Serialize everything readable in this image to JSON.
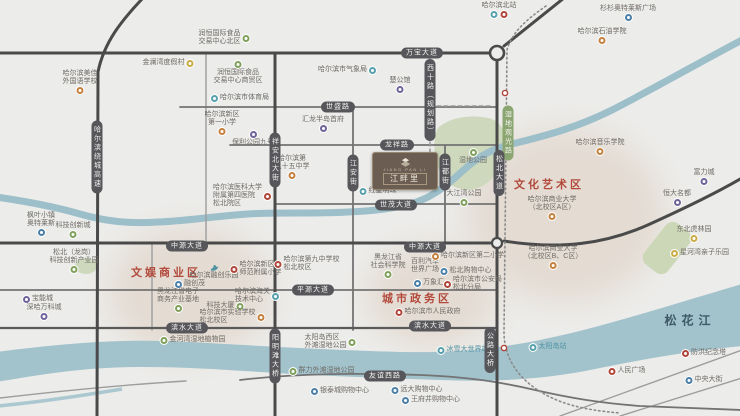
{
  "project": {
    "name": "江畔里",
    "tagline": "JIANG PAN LI"
  },
  "songhua_river": "松花江",
  "district_labels": [
    {
      "text": "文化艺术区",
      "x": 549,
      "y": 184
    },
    {
      "text": "文娱商业区",
      "x": 166,
      "y": 272
    },
    {
      "text": "城市政务区",
      "x": 417,
      "y": 298
    }
  ],
  "road_labels": [
    {
      "text": "万宝大道",
      "x": 422,
      "y": 53,
      "v": false,
      "green": false
    },
    {
      "text": "世盛路",
      "x": 338,
      "y": 107,
      "v": false,
      "green": false
    },
    {
      "text": "龙祥路",
      "x": 397,
      "y": 145,
      "v": false,
      "green": false
    },
    {
      "text": "世茂大道",
      "x": 396,
      "y": 205,
      "v": false,
      "green": false
    },
    {
      "text": "中源大道",
      "x": 187,
      "y": 246,
      "v": false,
      "green": false
    },
    {
      "text": "中源大道",
      "x": 425,
      "y": 247,
      "v": false,
      "green": false
    },
    {
      "text": "平源大道",
      "x": 313,
      "y": 290,
      "v": false,
      "green": false
    },
    {
      "text": "滨水大道",
      "x": 187,
      "y": 328,
      "v": false,
      "green": false
    },
    {
      "text": "滨水大道",
      "x": 430,
      "y": 326,
      "v": false,
      "green": false
    },
    {
      "text": "友谊西路",
      "x": 385,
      "y": 376,
      "v": false,
      "green": false
    },
    {
      "text": "哈尔滨绕城高速",
      "x": 97,
      "y": 157,
      "v": true,
      "green": false
    },
    {
      "text": "祥安北大街",
      "x": 275,
      "y": 160,
      "v": true,
      "green": false
    },
    {
      "text": "江安街",
      "x": 353,
      "y": 173,
      "v": true,
      "green": false
    },
    {
      "text": "江都街",
      "x": 445,
      "y": 172,
      "v": true,
      "green": false
    },
    {
      "text": "西十路（规划路）",
      "x": 430,
      "y": 100,
      "v": true,
      "green": false
    },
    {
      "text": "湿地观光路",
      "x": 508,
      "y": 133,
      "v": true,
      "green": true
    },
    {
      "text": "松北大道",
      "x": 499,
      "y": 173,
      "v": true,
      "green": false
    },
    {
      "text": "阳明滩大桥",
      "x": 275,
      "y": 356,
      "v": true,
      "green": false
    },
    {
      "text": "公路大桥",
      "x": 490,
      "y": 350,
      "v": true,
      "green": false
    }
  ],
  "pois": [
    {
      "lines": [
        "金澜湾度假村"
      ],
      "x": 168,
      "y": 63,
      "icon": "yellow",
      "pos": "right"
    },
    {
      "lines": [
        "哈尔滨美佳",
        "外国语学校"
      ],
      "x": 80,
      "y": 82,
      "icon": "orange",
      "pos": "below"
    },
    {
      "lines": [
        "润恒国际食品",
        "交易中心北区"
      ],
      "x": 224,
      "y": 38,
      "icon": "green",
      "pos": "right"
    },
    {
      "lines": [
        "润恒国际食品",
        "交易中心商贸区"
      ],
      "x": 238,
      "y": 73,
      "icon": "green",
      "pos": "above"
    },
    {
      "lines": [
        "哈尔滨市体育局"
      ],
      "x": 240,
      "y": 98,
      "icon": "teal",
      "pos": "left"
    },
    {
      "lines": [
        "哈尔滨市气象局"
      ],
      "x": 347,
      "y": 70,
      "icon": "teal",
      "pos": "right"
    },
    {
      "lines": [
        "楚公馆"
      ],
      "x": 400,
      "y": 85,
      "icon": "purple",
      "pos": "below"
    },
    {
      "lines": [
        "哈尔滨北站"
      ],
      "x": 499,
      "y": 10,
      "icon": [
        "teal",
        "red"
      ],
      "pos": "below"
    },
    {
      "lines": [
        "杉杉奥特莱斯广场"
      ],
      "x": 628,
      "y": 13,
      "icon": "blue",
      "pos": "below"
    },
    {
      "lines": [
        "哈尔滨石油学院"
      ],
      "x": 602,
      "y": 36,
      "icon": "orange",
      "pos": "below"
    },
    {
      "lines": [
        "哈尔滨新区",
        "第一小学"
      ],
      "x": 222,
      "y": 123,
      "icon": "orange",
      "pos": "below"
    },
    {
      "lines": [
        "保利公园九号"
      ],
      "x": 253,
      "y": 139,
      "icon": "purple",
      "pos": "above"
    },
    {
      "lines": [
        "汇龙半岛首府"
      ],
      "x": 323,
      "y": 124,
      "icon": "purple",
      "pos": "below"
    },
    {
      "lines": [
        "哈尔滨第",
        "九十五中学"
      ],
      "x": 292,
      "y": 167,
      "icon": "orange",
      "pos": "below"
    },
    {
      "lines": [
        "哈尔滨医科大学",
        "附属第四医院",
        "松北院区"
      ],
      "x": 242,
      "y": 196,
      "icon": "red",
      "pos": "right"
    },
    {
      "lines": [
        "红星明珠"
      ],
      "x": 378,
      "y": 191,
      "icon": "teal",
      "pos": "left"
    },
    {
      "lines": [
        "湿地公园"
      ],
      "x": 473,
      "y": 157,
      "icon": "green",
      "pos": "above"
    },
    {
      "lines": [
        "哈尔滨音乐学院"
      ],
      "x": 600,
      "y": 147,
      "icon": "orange",
      "pos": "below"
    },
    {
      "lines": [
        "哈尔滨商业大学",
        "（北校区A区）"
      ],
      "x": 552,
      "y": 208,
      "icon": "orange",
      "pos": "below"
    },
    {
      "lines": [
        "哈尔滨商业大学",
        "（北校区B、C区）"
      ],
      "x": 553,
      "y": 257,
      "icon": "orange",
      "pos": "below"
    },
    {
      "lines": [
        "富力城"
      ],
      "x": 704,
      "y": 177,
      "icon": "purple",
      "pos": "below"
    },
    {
      "lines": [
        "恒大名都"
      ],
      "x": 677,
      "y": 198,
      "icon": "purple",
      "pos": "below"
    },
    {
      "lines": [
        "东北虎林园"
      ],
      "x": 694,
      "y": 234,
      "icon": "yellow",
      "pos": "below"
    },
    {
      "lines": [
        "星河湾亲子乐园"
      ],
      "x": 700,
      "y": 253,
      "icon": "yellow",
      "pos": "left"
    },
    {
      "lines": [
        "大江湾公园"
      ],
      "x": 464,
      "y": 198,
      "icon": "green",
      "pos": "below"
    },
    {
      "lines": [
        "哈尔滨融创乐园"
      ],
      "x": 214,
      "y": 272,
      "icon": "swan",
      "pos": "above"
    },
    {
      "lines": [
        "融创茂"
      ],
      "x": 190,
      "y": 284,
      "icon": "blue",
      "pos": "left"
    },
    {
      "lines": [
        "哈尔滨新区",
        "师范附属小学"
      ],
      "x": 256,
      "y": 269,
      "icon": "red",
      "pos": "left"
    },
    {
      "lines": [
        "哈尔滨第九中学校",
        "松北校区"
      ],
      "x": 307,
      "y": 264,
      "icon": "red",
      "pos": "left"
    },
    {
      "lines": [
        "黑龙江省电子",
        "商务产业基地"
      ],
      "x": 178,
      "y": 300,
      "icon": "green",
      "pos": "below"
    },
    {
      "lines": [
        "科技大厦"
      ],
      "x": 225,
      "y": 306,
      "icon": "green",
      "pos": "right"
    },
    {
      "lines": [
        "哈尔滨海关",
        "技术中心"
      ],
      "x": 257,
      "y": 296,
      "icon": "teal",
      "pos": "right"
    },
    {
      "lines": [
        "哈尔滨市实验学校",
        "松北校区"
      ],
      "x": 232,
      "y": 317,
      "icon": "orange",
      "pos": "right"
    },
    {
      "lines": [
        "黑龙江省",
        "社会科学院"
      ],
      "x": 388,
      "y": 266,
      "icon": "green",
      "pos": "below"
    },
    {
      "lines": [
        "百利汽车",
        "世界广场"
      ],
      "x": 425,
      "y": 266,
      "icon": "none",
      "pos": "none"
    },
    {
      "lines": [
        "万象汇"
      ],
      "x": 429,
      "y": 283,
      "icon": "blue",
      "pos": "left"
    },
    {
      "lines": [
        "哈尔滨新区第二小学"
      ],
      "x": 468,
      "y": 256,
      "icon": "orange",
      "pos": "left"
    },
    {
      "lines": [
        "松北购物中心"
      ],
      "x": 466,
      "y": 271,
      "icon": "blue",
      "pos": "left"
    },
    {
      "lines": [
        "哈尔滨市公安局",
        "松北分局"
      ],
      "x": 473,
      "y": 284,
      "icon": "red",
      "pos": "left"
    },
    {
      "lines": [
        "哈尔滨市人民政府"
      ],
      "x": 428,
      "y": 312,
      "icon": "red",
      "pos": "left"
    },
    {
      "lines": [
        "松北（龙岗）",
        "科技创新产业园"
      ],
      "x": 74,
      "y": 261,
      "icon": "green",
      "pos": "below"
    },
    {
      "lines": [
        "宝能城"
      ],
      "x": 38,
      "y": 299,
      "icon": "purple",
      "pos": "left"
    },
    {
      "lines": [
        "深哈万科城"
      ],
      "x": 44,
      "y": 312,
      "icon": "purple",
      "pos": "below"
    },
    {
      "lines": [
        "枫叶小镇",
        "奥特莱斯"
      ],
      "x": 41,
      "y": 224,
      "icon": "blue",
      "pos": "below"
    },
    {
      "lines": [
        "科技创新城"
      ],
      "x": 73,
      "y": 230,
      "icon": "green",
      "pos": "below"
    },
    {
      "lines": [
        "金河湾湿地植物园"
      ],
      "x": 193,
      "y": 340,
      "icon": "green",
      "pos": "left"
    },
    {
      "lines": [
        "太阳岛西区",
        "外滩湿地公园"
      ],
      "x": 330,
      "y": 342,
      "icon": "green",
      "pos": "right"
    },
    {
      "lines": [
        "群力外滩湿地公园"
      ],
      "x": 322,
      "y": 371,
      "icon": "green",
      "pos": "left"
    },
    {
      "lines": [
        "冰雪大世界站"
      ],
      "x": 463,
      "y": 350,
      "icon": "teal",
      "pos": "left",
      "cls": "teal-text"
    },
    {
      "lines": [
        "太阳岛站"
      ],
      "x": 548,
      "y": 347,
      "icon": "teal",
      "pos": "left",
      "cls": "teal-text"
    },
    {
      "lines": [
        "银泰城购物中心"
      ],
      "x": 340,
      "y": 391,
      "icon": "blue",
      "pos": "left"
    },
    {
      "lines": [
        "远大购物中心"
      ],
      "x": 417,
      "y": 390,
      "icon": "blue",
      "pos": "left"
    },
    {
      "lines": [
        "王府井购物中心"
      ],
      "x": 431,
      "y": 400,
      "icon": "blue",
      "pos": "left"
    },
    {
      "lines": [
        "防洪纪念塔"
      ],
      "x": 704,
      "y": 353,
      "icon": "red",
      "pos": "left"
    },
    {
      "lines": [
        "人民广场"
      ],
      "x": 627,
      "y": 371,
      "icon": "red",
      "pos": "left"
    },
    {
      "lines": [
        "中央大街"
      ],
      "x": 704,
      "y": 380,
      "icon": "blue",
      "pos": "left"
    }
  ],
  "colors": {
    "background": "#ececea",
    "district_blob": "#e4dcd3",
    "river": "#a2c2cc",
    "creek": "#9dbfca",
    "park": "#cdd8bc",
    "road_major": "#4a4a4a",
    "road_pill": "#57575b",
    "pill_green": "#8ba670",
    "district_text": "#b2493b",
    "poi_text": "#6f6b66",
    "project_bg": "#6b5d51"
  }
}
